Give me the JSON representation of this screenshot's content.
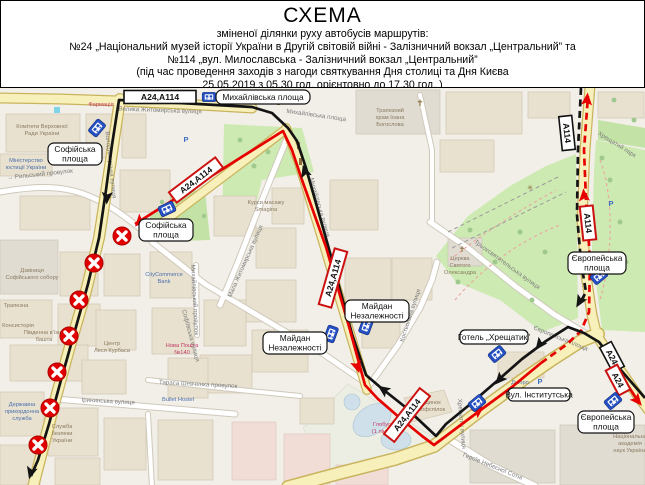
{
  "header": {
    "title": "СХЕМА",
    "subtitle": "зміненої ділянки руху автобусів маршрутів:",
    "line_route24": "№24 „Національний музей історії України в Другій світовій війні - Залізничний вокзал „Центральний” та",
    "line_route114": "№114 „вул. Милославська - Залізничний вокзал „Центральний”",
    "line_event": "(під час проведення заходів з нагоди святкування Дня столиці та Дня Києва",
    "line_time": "25.05.2019 з 05.30 год. орієнтовно до 17.30 год. )"
  },
  "colors": {
    "changed_route": "#e60000",
    "original_route": "#141414",
    "closed_marker": "#e00000",
    "bus_stop_blue": "#2550c4",
    "sign_red_border": "#cc1111"
  },
  "signs": {
    "top": "А24,А114",
    "proizd": "А24,А114",
    "mykhailivska": "А24,А114",
    "khreshchatyk": "А24,А114",
    "uzviz_black": "А114",
    "uzviz_red": "А114",
    "hrushevskoho_black": "А24",
    "hrushevskoho_red": "А24"
  },
  "labels": {
    "mykhailivska_square": "Михайлівська площа",
    "sofiivska_upper_1": "Софійська",
    "sofiivska_upper_2": "площа",
    "sofiivska_lower_1": "Софійська",
    "sofiivska_lower_2": "площа",
    "maidan_left_1": "Майдан",
    "maidan_left_2": "Незалежності",
    "maidan_right_1": "Майдан",
    "maidan_right_2": "Незалежності",
    "hotel_khreshchatyk": "Готель „Хрещатик”",
    "evropeiska_upper_1": "Європейська",
    "evropeiska_upper_2": "площа",
    "instytutska": "Вул. Інститутська",
    "evropeiska_lower_1": "Європейська",
    "evropeiska_lower_2": "площа"
  },
  "streets": {
    "zhytomyrska": "Велика Житомирська вулиця",
    "volodymyrska": "Володимирська вулиця",
    "mykhailivska_pl": "Михайлівська площа",
    "mykhailivska_vul": "Михайлівська вулиця",
    "mala_zhytomyrska": "Мала Житомирська вулиця",
    "sofiivska": "Софіївська вулиця",
    "kostolna": "Костьольна вулиця",
    "trokhsviatytelska": "Трьохсвятительська вулиця",
    "khreshchatyi_park": "Хрещатий парк",
    "irynynska": "Ірининська вулиця",
    "rylskyi": "→ Рильський провулок",
    "mykhailivskyi_prov": "Михайлівський провулок",
    "khreshchatyk": "Хрещатик вулиця",
    "heroiv": "Героїв Небесної Сотні",
    "shevchenka": "Тараса Шевченка провулок",
    "evropeiska_pl": "Європейська площа"
  },
  "poi": {
    "farmatsiia": "Фармація",
    "komitety_1": "Комітети Верховної",
    "komitety_2": "Ради України",
    "miniust_1": "Міністерство",
    "miniust_2": "юстиції України",
    "dzvinytsia_1": "Дзвіниця",
    "dzvinytsia_2": "Софійського собору",
    "trapezna": "Трапезна",
    "konsystoriia": "Консисторія",
    "bashta_1": "Південна в'їзна",
    "bashta_2": "башта",
    "kurbas_1": "Центр",
    "kurbas_2": "Леся Курбаса",
    "citycommerce_1": "CityCommerce",
    "citycommerce_2": "Bank",
    "novaposhta_1": "Нова Пошта",
    "novaposhta_2": "№140",
    "prykordon_1": "Державна",
    "prykordon_2": "прикордонна",
    "prykordon_3": "служба",
    "sbu_1": "Служба",
    "sbu_2": "безпеки",
    "sbu_3": "України",
    "bullet": "Bullet Hostel",
    "smagina_1": "Курси масажу",
    "smagina_2": "Smagina",
    "hlobus_1": "Глобус",
    "hlobus_2": "(1 лінія)",
    "profspilky_1": "Будинок",
    "profspilky_2": "профспілок",
    "dnipro": "Дніпро",
    "nanu_1": "Національна",
    "nanu_2": "академія",
    "nanu_3": "наук України",
    "trapezny_1": "Трапезний",
    "trapezny_2": "храм Іоана",
    "trapezny_3": "Богослова",
    "oleksandr_1": "Церква",
    "oleksandr_2": "Святого",
    "oleksandr_3": "Олександра",
    "parking": "Р"
  }
}
